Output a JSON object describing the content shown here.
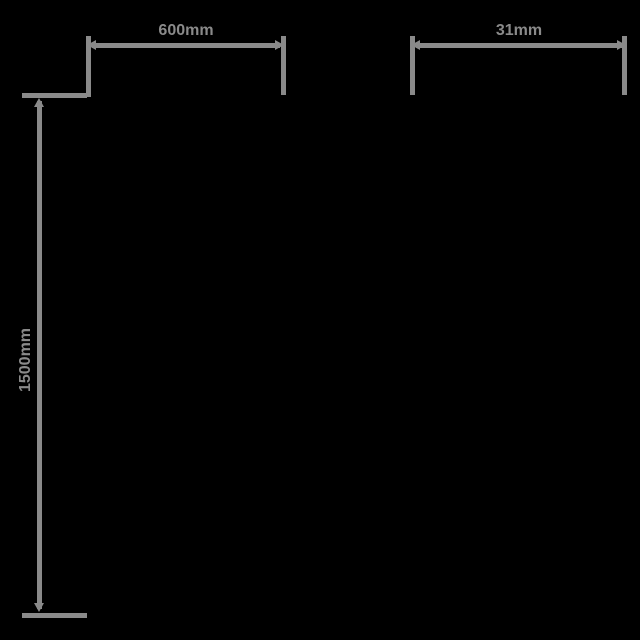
{
  "diagram": {
    "type": "product-dimension-drawing",
    "background_color": "#000000",
    "line_color": "#8a8a8a",
    "dimensions": {
      "width": {
        "label": "600mm",
        "orientation": "horizontal"
      },
      "depth": {
        "label": "31mm",
        "orientation": "horizontal"
      },
      "height": {
        "label": "1500mm",
        "orientation": "vertical"
      }
    }
  }
}
